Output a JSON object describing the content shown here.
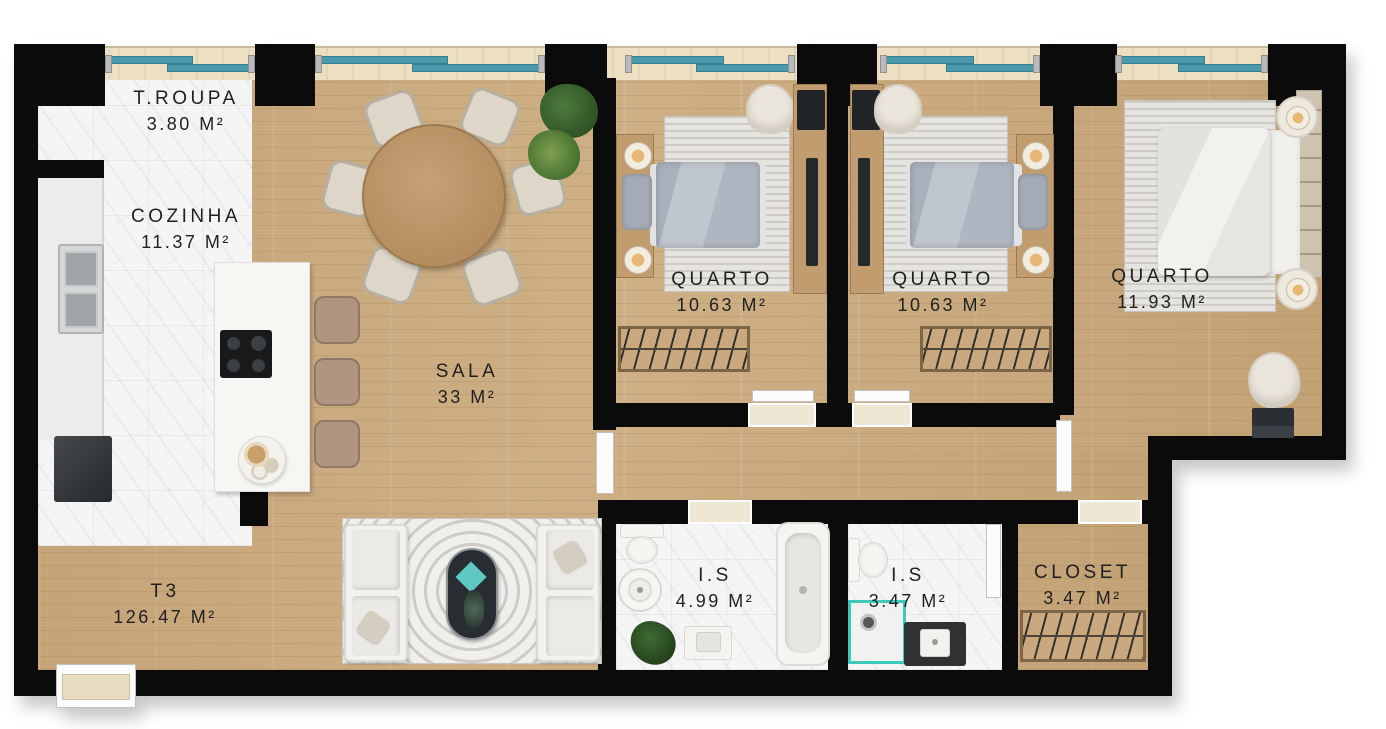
{
  "plan": {
    "type": "apartment-floor-plan",
    "language": "pt-BR",
    "rooms": [
      {
        "name": "T.ROUPA",
        "area": "3.80 M²"
      },
      {
        "name": "COZINHA",
        "area": "11.37 M²"
      },
      {
        "name": "SALA",
        "area": "33 M²"
      },
      {
        "name": "QUARTO",
        "area": "10.63 M²"
      },
      {
        "name": "QUARTO",
        "area": "10.63 M²"
      },
      {
        "name": "QUARTO",
        "area": "11.93 M²"
      },
      {
        "name": "T3",
        "area": "126.47 M²"
      },
      {
        "name": "I.S",
        "area": "4.99 M²"
      },
      {
        "name": "I.S",
        "area": "3.47 M²"
      },
      {
        "name": "CLOSET",
        "area": "3.47 M²"
      }
    ],
    "colors": {
      "wall": "#0b0b0b",
      "wood_floor": "#c9a97d",
      "marble_floor": "#f5f5f6",
      "window_glass": "#4a9aab",
      "wall_sill": "#ecdfc2",
      "shower_accent": "#3cc9b9",
      "label_text": "#1f1f1f"
    }
  }
}
